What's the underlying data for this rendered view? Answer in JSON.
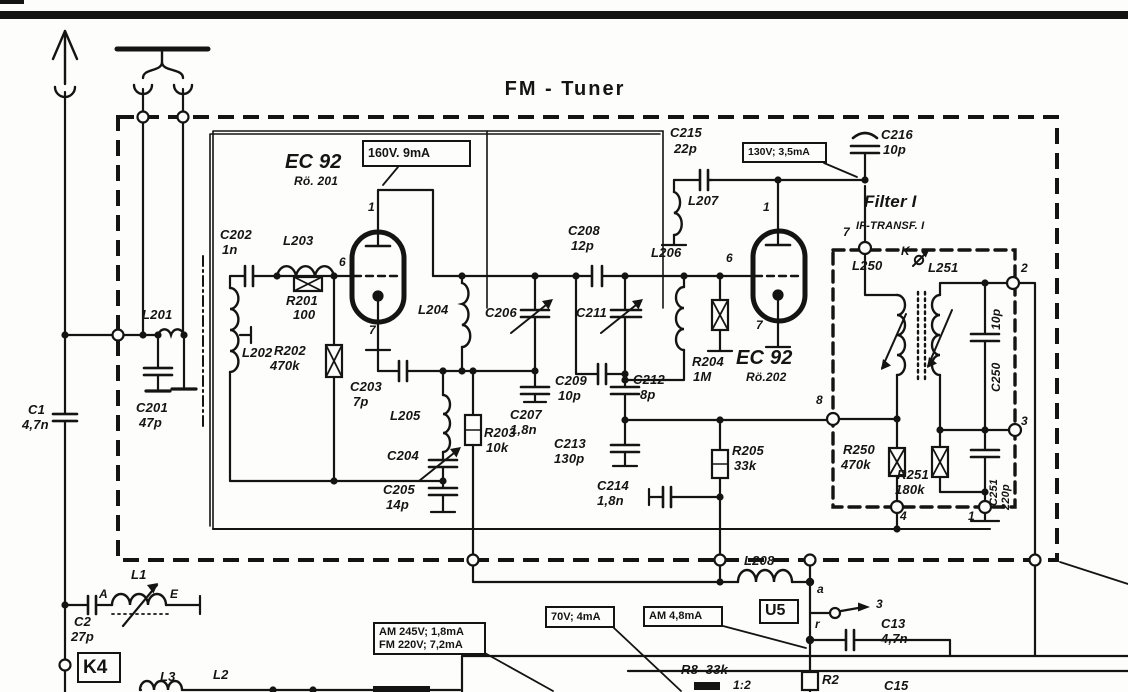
{
  "title": "FM - Tuner",
  "colors": {
    "ink": "#141414",
    "paper": "#fdfdfb"
  },
  "callouts": [
    {
      "n": "voltage-160v",
      "lines": [
        "160V. 9mA"
      ],
      "x": 362,
      "y": 140,
      "w": 109,
      "h": 27,
      "fs": 12.5
    },
    {
      "n": "voltage-130v",
      "lines": [
        "130V; 3,5mA"
      ],
      "x": 742,
      "y": 142,
      "w": 85,
      "h": 21,
      "fs": 10.5
    },
    {
      "n": "voltage-70v",
      "lines": [
        "70V; 4mA"
      ],
      "x": 545,
      "y": 606,
      "w": 70,
      "h": 22,
      "fs": 11
    },
    {
      "n": "current-am48",
      "lines": [
        "AM 4,8mA"
      ],
      "x": 643,
      "y": 606,
      "w": 80,
      "h": 21,
      "fs": 11
    },
    {
      "n": "voltage-am-fm",
      "lines": [
        "AM 245V; 1,8mA",
        "FM 220V; 7,2mA"
      ],
      "x": 373,
      "y": 622,
      "w": 113,
      "h": 33,
      "fs": 11
    },
    {
      "n": "connector-u5",
      "lines": [
        "U5"
      ],
      "x": 759,
      "y": 599,
      "w": 40,
      "h": 25,
      "fs": 16
    },
    {
      "n": "connector-k4",
      "lines": [
        "K4"
      ],
      "x": 77,
      "y": 652,
      "w": 44,
      "h": 31,
      "fs": 19
    }
  ],
  "labels": [
    {
      "n": "c1-ref",
      "t": "C1",
      "x": 28,
      "y": 403
    },
    {
      "n": "c1-val",
      "t": "4,7n",
      "x": 22,
      "y": 418
    },
    {
      "n": "c2-ref",
      "t": "C2",
      "x": 74,
      "y": 615
    },
    {
      "n": "c2-val",
      "t": "27p",
      "x": 71,
      "y": 630
    },
    {
      "n": "l1",
      "t": "L1",
      "x": 131,
      "y": 568
    },
    {
      "n": "l1-terminal-a",
      "t": "A",
      "x": 99,
      "y": 588,
      "fs": 12
    },
    {
      "n": "l1-terminal-e",
      "t": "E",
      "x": 170,
      "y": 588,
      "fs": 12
    },
    {
      "n": "l3",
      "t": "L3",
      "x": 160,
      "y": 670
    },
    {
      "n": "l2",
      "t": "L2",
      "x": 213,
      "y": 668
    },
    {
      "n": "c201-ref",
      "t": "C201",
      "x": 136,
      "y": 401
    },
    {
      "n": "c201-val",
      "t": "47p",
      "x": 139,
      "y": 416
    },
    {
      "n": "l201",
      "t": "L201",
      "x": 142,
      "y": 308
    },
    {
      "n": "l202",
      "t": "L202",
      "x": 242,
      "y": 346
    },
    {
      "n": "c202-ref",
      "t": "C202",
      "x": 220,
      "y": 228
    },
    {
      "n": "c202-val",
      "t": "1n",
      "x": 222,
      "y": 243
    },
    {
      "n": "l203",
      "t": "L203",
      "x": 283,
      "y": 234
    },
    {
      "n": "r201-ref",
      "t": "R201",
      "x": 286,
      "y": 294
    },
    {
      "n": "r201-val",
      "t": "100",
      "x": 293,
      "y": 308
    },
    {
      "n": "r202-ref",
      "t": "R202",
      "x": 274,
      "y": 344
    },
    {
      "n": "r202-val",
      "t": "470k",
      "x": 270,
      "y": 359
    },
    {
      "n": "tube1-type",
      "t": "EC 92",
      "x": 285,
      "y": 152,
      "fs": 20
    },
    {
      "n": "tube1-ref",
      "t": "Rö. 201",
      "x": 294,
      "y": 175,
      "fs": 12
    },
    {
      "n": "tube1-pin1",
      "t": "1",
      "x": 368,
      "y": 201,
      "fs": 12
    },
    {
      "n": "tube1-pin6",
      "t": "6",
      "x": 339,
      "y": 256,
      "fs": 12
    },
    {
      "n": "tube1-pin7",
      "t": "7",
      "x": 369,
      "y": 324,
      "fs": 12
    },
    {
      "n": "c203-ref",
      "t": "C203",
      "x": 350,
      "y": 380
    },
    {
      "n": "c203-val",
      "t": "7p",
      "x": 353,
      "y": 395
    },
    {
      "n": "l204",
      "t": "L204",
      "x": 418,
      "y": 303
    },
    {
      "n": "l205",
      "t": "L205",
      "x": 390,
      "y": 409
    },
    {
      "n": "c204",
      "t": "C204",
      "x": 387,
      "y": 449
    },
    {
      "n": "c205-ref",
      "t": "C205",
      "x": 383,
      "y": 483
    },
    {
      "n": "c205-val",
      "t": "14p",
      "x": 386,
      "y": 498
    },
    {
      "n": "r203-ref",
      "t": "R203",
      "x": 484,
      "y": 426
    },
    {
      "n": "r203-val",
      "t": "10k",
      "x": 486,
      "y": 441
    },
    {
      "n": "c206",
      "t": "C206",
      "x": 485,
      "y": 306
    },
    {
      "n": "c207-ref",
      "t": "C207",
      "x": 510,
      "y": 408
    },
    {
      "n": "c207-val",
      "t": "1,8n",
      "x": 510,
      "y": 423
    },
    {
      "n": "c208-ref",
      "t": "C208",
      "x": 568,
      "y": 224
    },
    {
      "n": "c208-val",
      "t": "12p",
      "x": 571,
      "y": 239
    },
    {
      "n": "c209-ref",
      "t": "C209",
      "x": 555,
      "y": 374
    },
    {
      "n": "c209-val",
      "t": "10p",
      "x": 558,
      "y": 389
    },
    {
      "n": "c211",
      "t": "C211",
      "x": 576,
      "y": 306
    },
    {
      "n": "c212-ref",
      "t": "C212",
      "x": 633,
      "y": 373
    },
    {
      "n": "c212-val",
      "t": "8p",
      "x": 640,
      "y": 388
    },
    {
      "n": "c213-ref",
      "t": "C213",
      "x": 554,
      "y": 437
    },
    {
      "n": "c213-val",
      "t": "130p",
      "x": 554,
      "y": 452
    },
    {
      "n": "c214-ref",
      "t": "C214",
      "x": 597,
      "y": 479
    },
    {
      "n": "c214-val",
      "t": "1,8n",
      "x": 597,
      "y": 494
    },
    {
      "n": "r204-ref",
      "t": "R204",
      "x": 692,
      "y": 355
    },
    {
      "n": "r204-val",
      "t": "1M",
      "x": 693,
      "y": 370
    },
    {
      "n": "r205-ref",
      "t": "R205",
      "x": 732,
      "y": 444
    },
    {
      "n": "r205-val",
      "t": "33k",
      "x": 734,
      "y": 459
    },
    {
      "n": "l206",
      "t": "L206",
      "x": 651,
      "y": 246
    },
    {
      "n": "c215-ref",
      "t": "C215",
      "x": 670,
      "y": 126
    },
    {
      "n": "c215-val",
      "t": "22p",
      "x": 674,
      "y": 142
    },
    {
      "n": "l207",
      "t": "L207",
      "x": 688,
      "y": 194
    },
    {
      "n": "tube2-type",
      "t": "EC 92",
      "x": 736,
      "y": 348,
      "fs": 20
    },
    {
      "n": "tube2-ref",
      "t": "Rö.202",
      "x": 746,
      "y": 371,
      "fs": 12
    },
    {
      "n": "tube2-pin1",
      "t": "1",
      "x": 763,
      "y": 201,
      "fs": 12
    },
    {
      "n": "tube2-pin6",
      "t": "6",
      "x": 726,
      "y": 252,
      "fs": 12
    },
    {
      "n": "tube2-pin7",
      "t": "7",
      "x": 756,
      "y": 319,
      "fs": 12
    },
    {
      "n": "c216-ref",
      "t": "C216",
      "x": 881,
      "y": 128
    },
    {
      "n": "c216-val",
      "t": "10p",
      "x": 883,
      "y": 143
    },
    {
      "n": "filter-title",
      "t": "Filter I",
      "x": 864,
      "y": 193,
      "fs": 17
    },
    {
      "n": "filter-subtitle",
      "t": "IF-TRANSF. I",
      "x": 856,
      "y": 221,
      "fs": 11
    },
    {
      "n": "filter-term7",
      "t": "7",
      "x": 843,
      "y": 226,
      "fs": 12
    },
    {
      "n": "l250",
      "t": "L250",
      "x": 852,
      "y": 259
    },
    {
      "n": "coupling-k",
      "t": "K",
      "x": 901,
      "y": 245,
      "fs": 12
    },
    {
      "n": "l251",
      "t": "L251",
      "x": 928,
      "y": 261
    },
    {
      "n": "filter-term2",
      "t": "2",
      "x": 1021,
      "y": 262,
      "fs": 12
    },
    {
      "n": "c250-val",
      "t": "10p",
      "x": 990,
      "y": 330,
      "rot": 1,
      "fs": 12
    },
    {
      "n": "c250-ref",
      "t": "C250",
      "x": 990,
      "y": 392,
      "rot": 1,
      "fs": 12
    },
    {
      "n": "filter-term3",
      "t": "3",
      "x": 1021,
      "y": 415,
      "fs": 12
    },
    {
      "n": "filter-term8",
      "t": "8",
      "x": 816,
      "y": 394,
      "fs": 12
    },
    {
      "n": "r250-ref",
      "t": "R250",
      "x": 843,
      "y": 443
    },
    {
      "n": "r250-val",
      "t": "470k",
      "x": 841,
      "y": 458
    },
    {
      "n": "r251-ref",
      "t": "R251",
      "x": 897,
      "y": 468
    },
    {
      "n": "r251-val",
      "t": "180k",
      "x": 895,
      "y": 483
    },
    {
      "n": "c251-ref",
      "t": "C251",
      "x": 989,
      "y": 506,
      "rot": 1,
      "fs": 11
    },
    {
      "n": "c251-val",
      "t": "220p",
      "x": 1001,
      "y": 510,
      "rot": 1,
      "fs": 11
    },
    {
      "n": "filter-term4",
      "t": "4",
      "x": 900,
      "y": 510,
      "fs": 12
    },
    {
      "n": "filter-term1",
      "t": "1",
      "x": 968,
      "y": 510,
      "fs": 12
    },
    {
      "n": "l208",
      "t": "L208",
      "x": 744,
      "y": 554
    },
    {
      "n": "point-a",
      "t": "a",
      "x": 817,
      "y": 583,
      "fs": 12
    },
    {
      "n": "point-r",
      "t": "r",
      "x": 815,
      "y": 618,
      "fs": 12
    },
    {
      "n": "switch-term3",
      "t": "3",
      "x": 876,
      "y": 598,
      "fs": 12
    },
    {
      "n": "c13-ref",
      "t": "C13",
      "x": 881,
      "y": 617
    },
    {
      "n": "c13-val",
      "t": "4,7n",
      "x": 881,
      "y": 632
    },
    {
      "n": "r8",
      "t": "R8  33k",
      "x": 681,
      "y": 663
    },
    {
      "n": "r2",
      "t": "R2",
      "x": 822,
      "y": 673
    },
    {
      "n": "c15",
      "t": "C15",
      "x": 884,
      "y": 679
    },
    {
      "n": "ratio",
      "t": "1:2",
      "x": 733,
      "y": 679,
      "fs": 12
    }
  ]
}
